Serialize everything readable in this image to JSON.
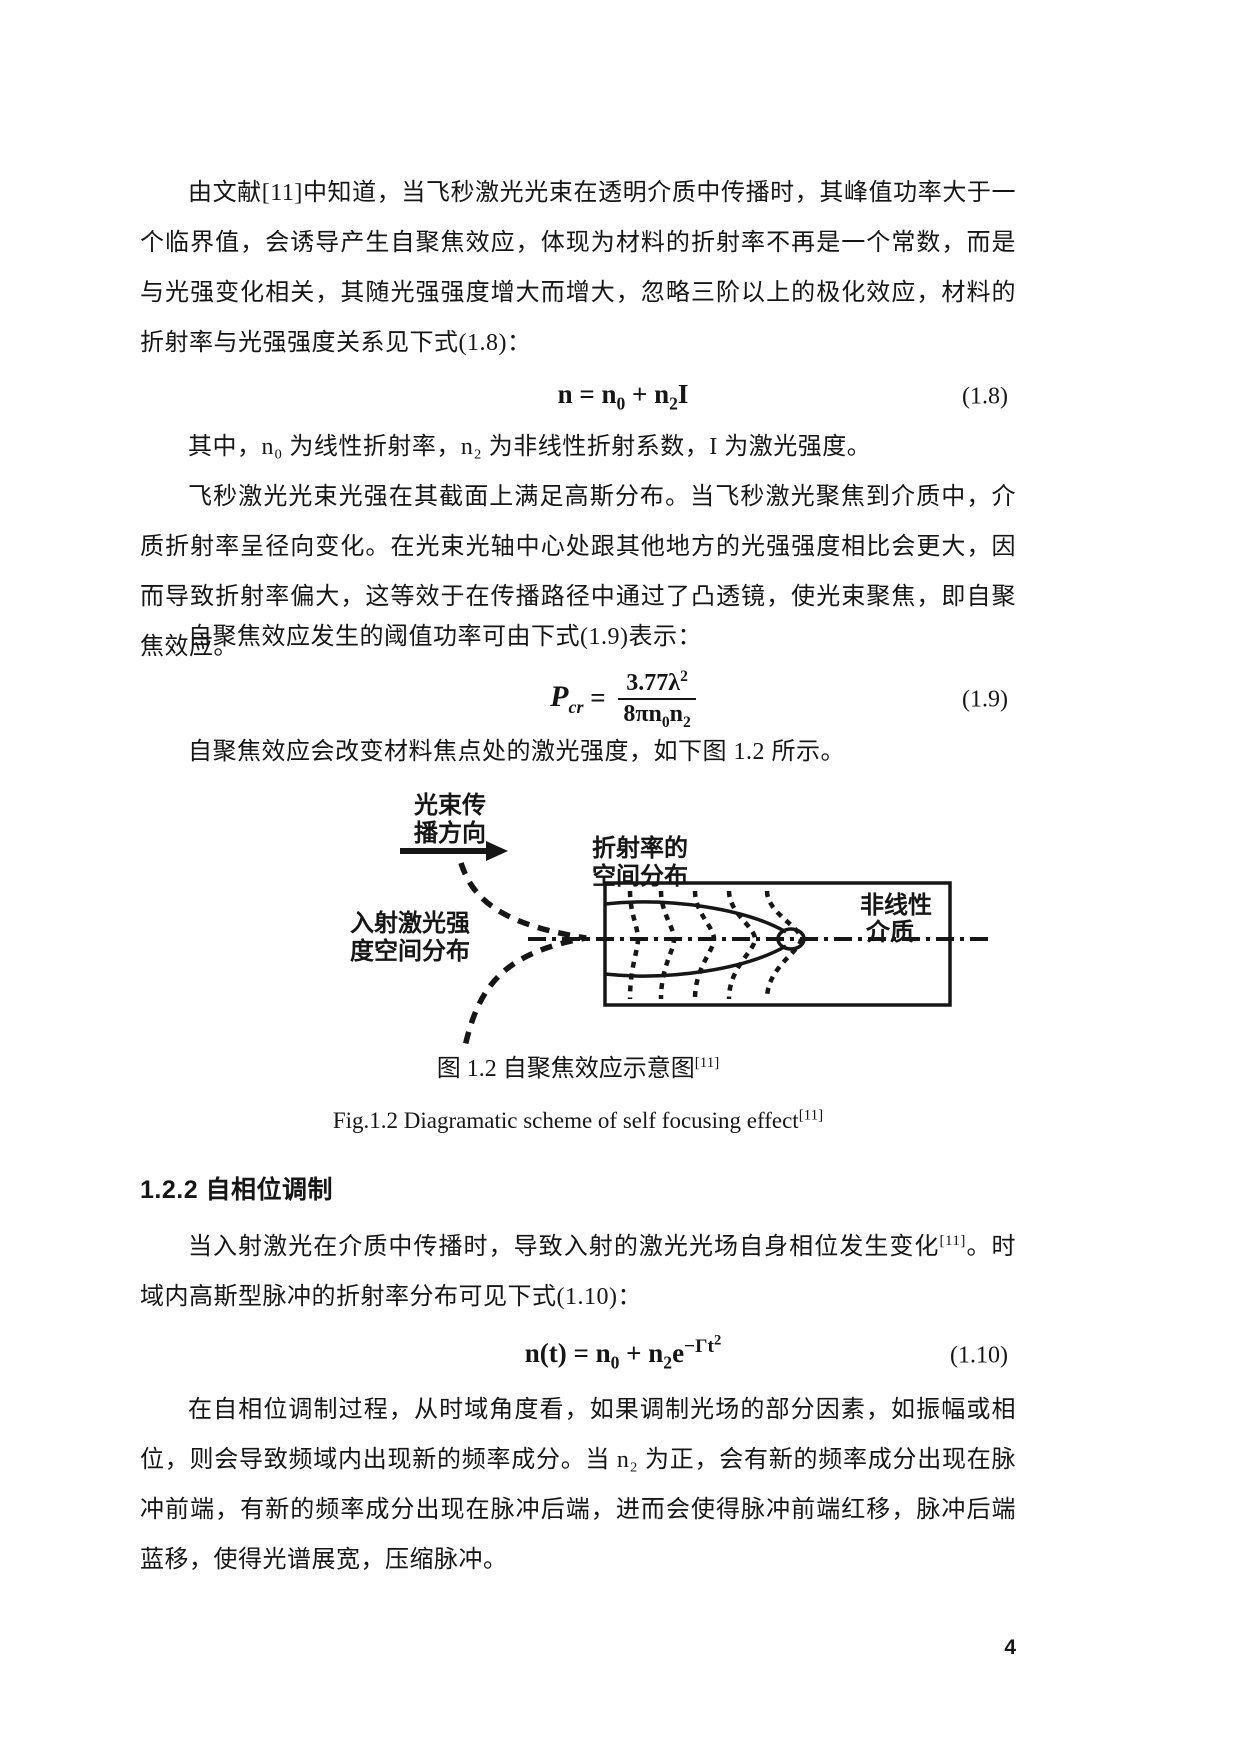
{
  "page": {
    "number": "4"
  },
  "paragraphs": {
    "p1": "由文献[11]中知道，当飞秒激光光束在透明介质中传播时，其峰值功率大于一个临界值，会诱导产生自聚焦效应，体现为材料的折射率不再是一个常数，而是与光强变化相关，其随光强强度增大而增大，忽略三阶以上的极化效应，材料的折射率与光强强度关系见下式(1.8)：",
    "p2": "其中，n₀ 为线性折射率，n₂ 为非线性折射系数，I 为激光强度。",
    "p3": "飞秒激光光束光强在其截面上满足高斯分布。当飞秒激光聚焦到介质中，介质折射率呈径向变化。在光束光轴中心处跟其他地方的光强强度相比会更大，因而导致折射率偏大，这等效于在传播路径中通过了凸透镜，使光束聚焦，即自聚焦效应。",
    "p4": "自聚焦效应发生的阈值功率可由下式(1.9)表示：",
    "p5": "自聚焦效应会改变材料焦点处的激光强度，如下图 1.2 所示。",
    "p6_a": "当入射激光在介质中传播时，导致入射的激光光场自身相位发生变化",
    "p6_ref": "[11]",
    "p6_b": "。时域内高斯型脉冲的折射率分布可见下式(1.10)：",
    "p7": "在自相位调制过程，从时域角度看，如果调制光场的部分因素，如振幅或相位，则会导致频域内出现新的频率成分。当 n₂ 为正，会有新的频率成分出现在脉冲前端，有新的频率成分出现在脉冲后端，进而会使得脉冲前端红移，脉冲后端蓝移，使得光谱展宽，压缩脉冲。"
  },
  "equations": {
    "eq18": {
      "p1": "n = n",
      "s1": "0",
      "p2": " + n",
      "s2": "2",
      "p3": "I",
      "num": "(1.8)"
    },
    "eq19": {
      "p": "P",
      "psub": "cr",
      "eq": " = ",
      "fnum_a": "3.77λ",
      "fnum_sup": "2",
      "fden_a": "8πn",
      "fden_s1": "0",
      "fden_b": "n",
      "fden_s2": "2",
      "num": "(1.9)"
    },
    "eq110": {
      "p1": "n(t) = n",
      "s1": "0",
      "p2": " + n",
      "s2": "2",
      "p3": "e",
      "exp_a": "−Γt",
      "exp_sup": "2",
      "num": "(1.10)"
    }
  },
  "section": {
    "title": "1.2.2  自相位调制"
  },
  "figure": {
    "beam_dir_line1": "光束传",
    "beam_dir_line2": "播方向",
    "refr_line1": "折射率的",
    "refr_line2": "空间分布",
    "medium_line1": "非线性",
    "medium_line2": "介质",
    "incident_line1": "入射激光强",
    "incident_line2": "度空间分布",
    "caption_cn": "图 1.2  自聚焦效应示意图",
    "caption_cn_ref": "[11]",
    "caption_en": "Fig.1.2 Diagramatic scheme of self focusing effect",
    "caption_en_ref": "[11]"
  }
}
